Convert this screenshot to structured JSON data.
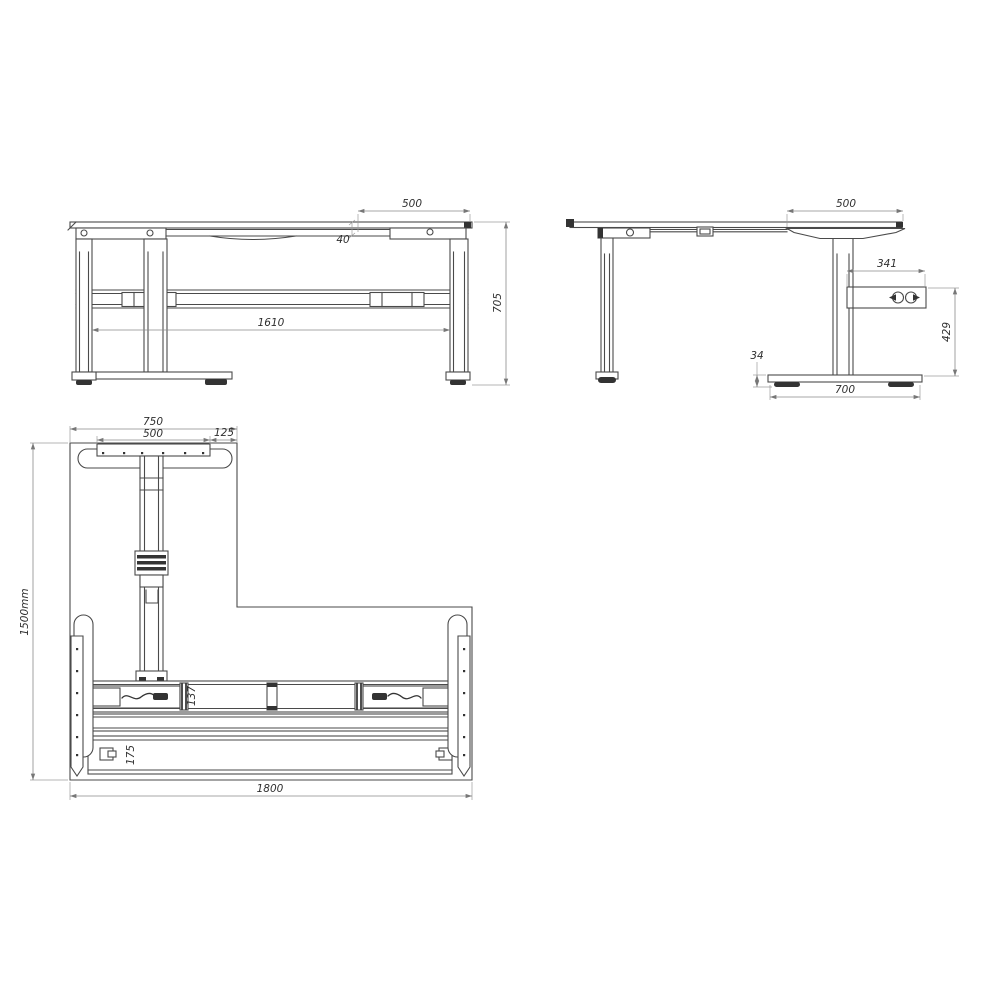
{
  "front_view": {
    "dim_top_right_overhang": "500",
    "dim_frame_thickness": "40",
    "dim_leg_spacing": "1610",
    "dim_overall_height": "705"
  },
  "side_view": {
    "dim_top_depth": "500",
    "dim_control_box_length": "341",
    "dim_control_box_height": "429",
    "dim_foot_height": "34",
    "dim_foot_length": "700"
  },
  "plan_view": {
    "dim_return_top_width": "750",
    "dim_top_bracket_length": "500",
    "dim_edge_offset": "125",
    "dim_overall_depth": "1500mm",
    "dim_crossbeam_width": "137",
    "dim_rear_rail_width": "175",
    "dim_overall_width": "1800"
  }
}
